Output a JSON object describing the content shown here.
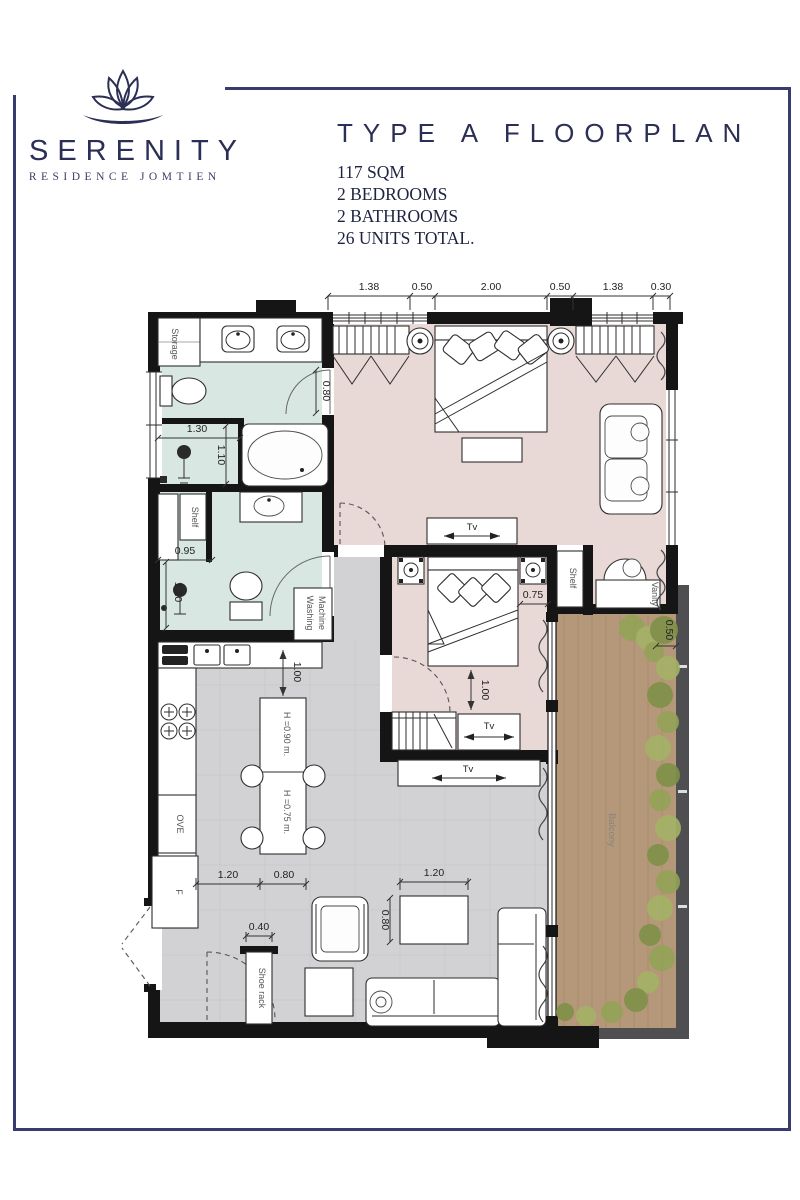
{
  "brand": {
    "name": "SERENITY",
    "subtitle": "RESIDENCE JOMTIEN"
  },
  "header": {
    "title": "TYPE A FLOORPLAN",
    "specs": [
      "117 SQM",
      "2 BEDROOMS",
      "2 BATHROOMS",
      "26 UNITS TOTAL."
    ]
  },
  "colors": {
    "accent": "#373b6d",
    "wall": "#151515",
    "bath_floor": "#d9e7e2",
    "bedroom_floor": "#e8d8d6",
    "living_floor": "#d2d2d5",
    "balcony_wood": "#b49879",
    "plant_green": "#8fa054"
  },
  "plan": {
    "dims_top": [
      "1.38",
      "0.50",
      "2.00",
      "0.50",
      "1.38",
      "0.30"
    ],
    "dims": {
      "bath_door": "0.80",
      "bath_130": "1.30",
      "bath_110": "1.10",
      "bath2_095": "0.95",
      "bath2_120": "1.20",
      "kitchen_100": "1.00",
      "counter_h": "H =0.90 m.",
      "table_h": "H =0.75 m.",
      "kitchen_120": "1.20",
      "kitchen_080": "0.80",
      "bed2_075": "0.75",
      "bed2_100": "1.00",
      "balcony_050": "0.50",
      "living_120": "1.20",
      "living_080": "0.80",
      "entry_040": "0.40"
    },
    "labels": {
      "storage": "Storage",
      "shelf_bath": "Shelf",
      "washing_line1": "Washing",
      "washing_line2": "Machine",
      "shelf_master": "Shelf",
      "vanity": "Vanity",
      "balcony": "Balcony",
      "shoe_rack": "Shoe rack",
      "oven": "OVE",
      "fridge": "F",
      "tv": "Tv"
    }
  }
}
